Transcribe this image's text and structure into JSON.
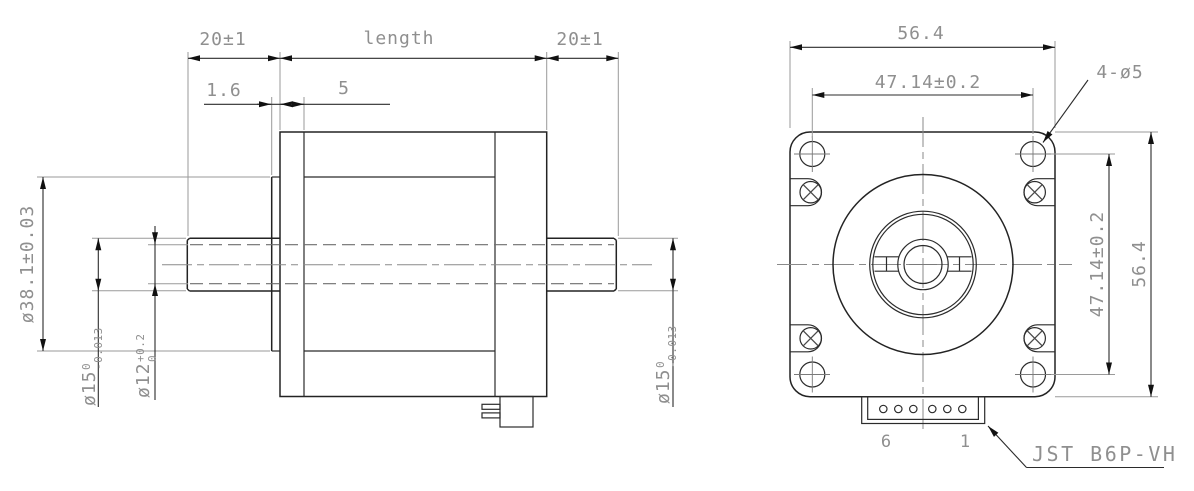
{
  "colors": {
    "background": "#ffffff",
    "object_line": "#232323",
    "dim_line": "#2b2b2b",
    "dim_text": "#8f8f8f"
  },
  "side_view": {
    "front_shaft_length": "20±1",
    "body_length_label": "length",
    "rear_shaft_length": "20±1",
    "boss_thickness": "1.6",
    "pilot_depth": "5",
    "boss_diameter": "ø38.1±0.03",
    "front_shaft_diameter": {
      "main": "ø15",
      "sup": "0",
      "sub": "-0.013"
    },
    "shaft_flat_diameter": {
      "main": "ø12",
      "sup": "+0.2",
      "sub": "0"
    },
    "rear_shaft_diameter": {
      "main": "ø15",
      "sup": "0",
      "sub": "-0.013"
    }
  },
  "front_view": {
    "overall_width": "56.4",
    "overall_height": "56.4",
    "hole_spacing_horizontal": "47.14±0.2",
    "hole_spacing_vertical": "47.14±0.2",
    "mounting_holes": "4-ø5",
    "connector_pin_first": "6",
    "connector_pin_last": "1",
    "connector_label": "JST B6P-VH"
  }
}
